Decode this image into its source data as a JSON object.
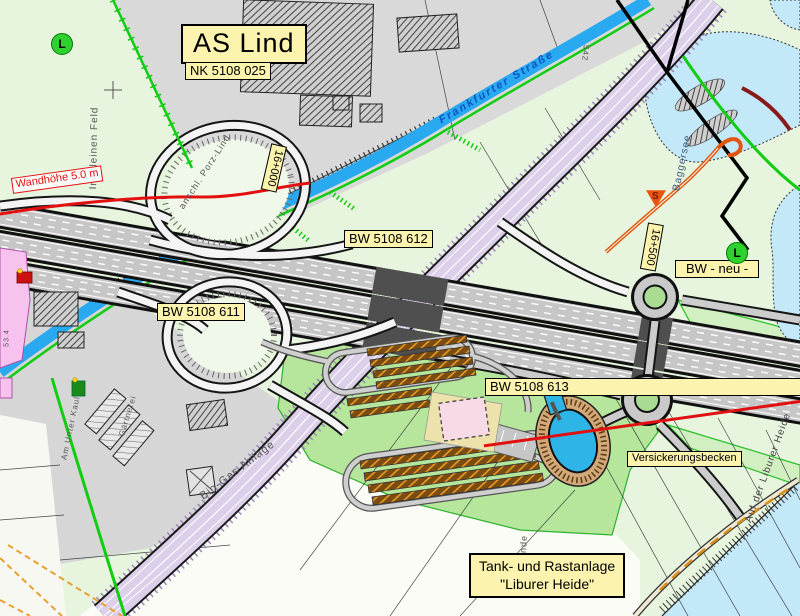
{
  "map": {
    "labels": {
      "interchange_title": "AS Lind",
      "nk_number": "NK 5108 025",
      "bw_612": "BW 5108 612",
      "bw_611": "BW 5108 611",
      "bw_613": "BW 5108 613",
      "bw_neu": "BW - neu -",
      "versickerungsbecken": "Versickerungsbecken",
      "rest_area_line1": "Tank- und Rastanlage",
      "rest_area_line2": "\"Liburer Heide\"",
      "wall_height": "Wandhöhe 5.0 m",
      "chainage_16000": "16+000",
      "chainage_16500": "16+500",
      "frankfurter_strasse": "Frankfurter Straße",
      "baggersee": "Baggersee",
      "im_kleinen_feld": "Im kleinen Feld",
      "anschl_porz_lind": "anschl. Porz-Lind",
      "bio_gas_anlage": "Bio-Gas Anlage",
      "gaertnerei": "Gärtnerei",
      "auf_der_liburer_heide": "Auf der Liburer Heide",
      "am_unter_kaul": "Am Unter Kaul",
      "road_fragment": "ende",
      "elevation_53_4": "53.4",
      "elevation_542": "542",
      "l_marker": "L",
      "s_marker": "S"
    },
    "colors": {
      "label_bg": "#fcf3ae",
      "label_border": "#000000",
      "alert_red": "#e31010",
      "stream_blue": "#29a9f0",
      "lake_blue": "#c3e8f8",
      "field_green": "#e7f5de",
      "rest_area_green": "#b5e69c",
      "urban_gray": "#d9d9d9",
      "road_purple": "#dccfe9",
      "marker_green": "#2ed12e",
      "parking_orange": "#e89a28",
      "basin_blue": "#2cb5e6"
    }
  }
}
